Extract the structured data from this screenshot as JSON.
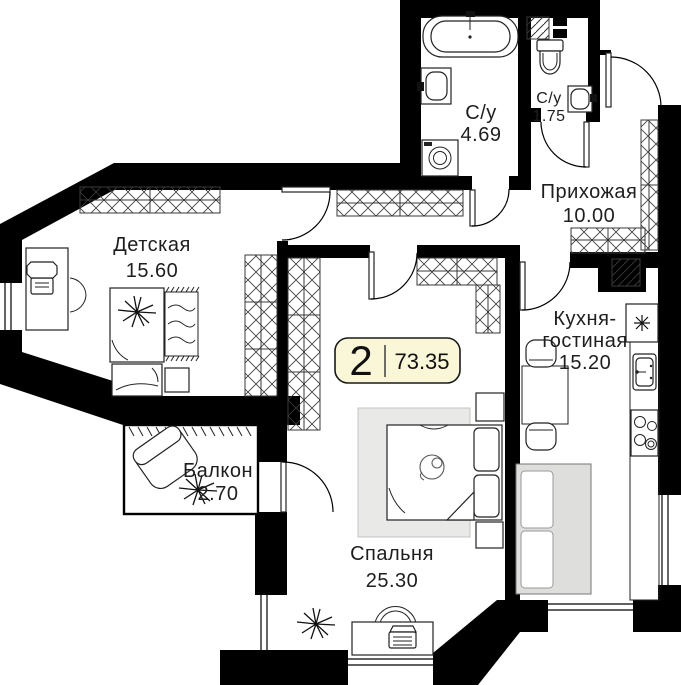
{
  "badge": {
    "rooms_count": "2",
    "total_area": "73.35"
  },
  "rooms": {
    "children": {
      "name": "Детская",
      "area": "15.60"
    },
    "balcony": {
      "name": "Балкон",
      "area": "2.70"
    },
    "bedroom": {
      "name": "Спальня",
      "area": "25.30"
    },
    "kitchen": {
      "name_line1": "Кухня-",
      "name_line2": "гостиная",
      "area": "15.20"
    },
    "hallway": {
      "name": "Прихожая",
      "area": "10.00"
    },
    "bathroom": {
      "name": "С/у",
      "area": "4.69"
    },
    "wc": {
      "name": "С/у",
      "area": "1.75"
    }
  },
  "colors": {
    "wall": "#000000",
    "badge_bg": "#faf6d8",
    "badge_border": "#1a1a1a",
    "rug_gray": "#e9e9e7",
    "sofa_gray": "#dededc",
    "text": "#1e1e1e"
  }
}
